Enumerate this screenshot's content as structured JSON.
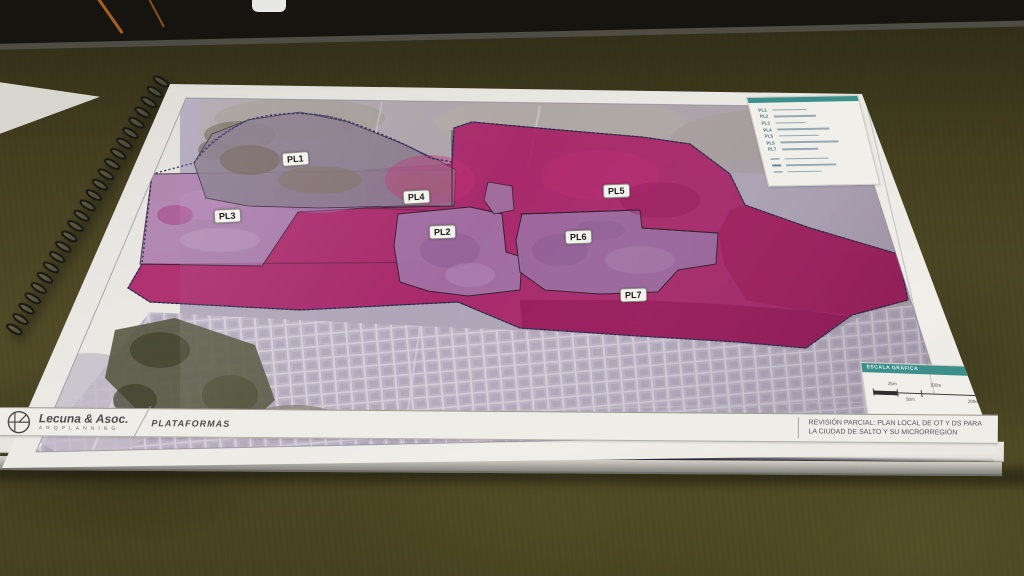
{
  "map": {
    "zones": [
      {
        "label": "PL1"
      },
      {
        "label": "PL2"
      },
      {
        "label": "PL3"
      },
      {
        "label": "PL4"
      },
      {
        "label": "PL5"
      },
      {
        "label": "PL6"
      },
      {
        "label": "PL7"
      }
    ]
  },
  "legend": {
    "items": [
      "PL1",
      "PL2",
      "PL3",
      "PL4",
      "PL5",
      "PL6",
      "PL7"
    ]
  },
  "scale": {
    "title": "ESCALA GRÁFICA",
    "labels": {
      "l25": "25m",
      "l50": "50m",
      "l100": "100m",
      "l200": "200m"
    }
  },
  "footer": {
    "brand": "Lecuna & Asoc.",
    "brand_sub": "ARQPLANNING",
    "sheet_label": "PLATAFORMAS",
    "project_title_line1": "REVISIÓN PARCIAL: PLAN LOCAL DE OT Y DS PARA",
    "project_title_line2": "LA CIUDAD DE SALTO Y SU MICRORREGIÓN"
  },
  "colors": {
    "zone_magenta": "#a81a62",
    "zone_purple": "#a271a5",
    "zone_gray": "#867889",
    "teal_bar": "#3c8f8a",
    "table_olive": "#4a4624"
  }
}
